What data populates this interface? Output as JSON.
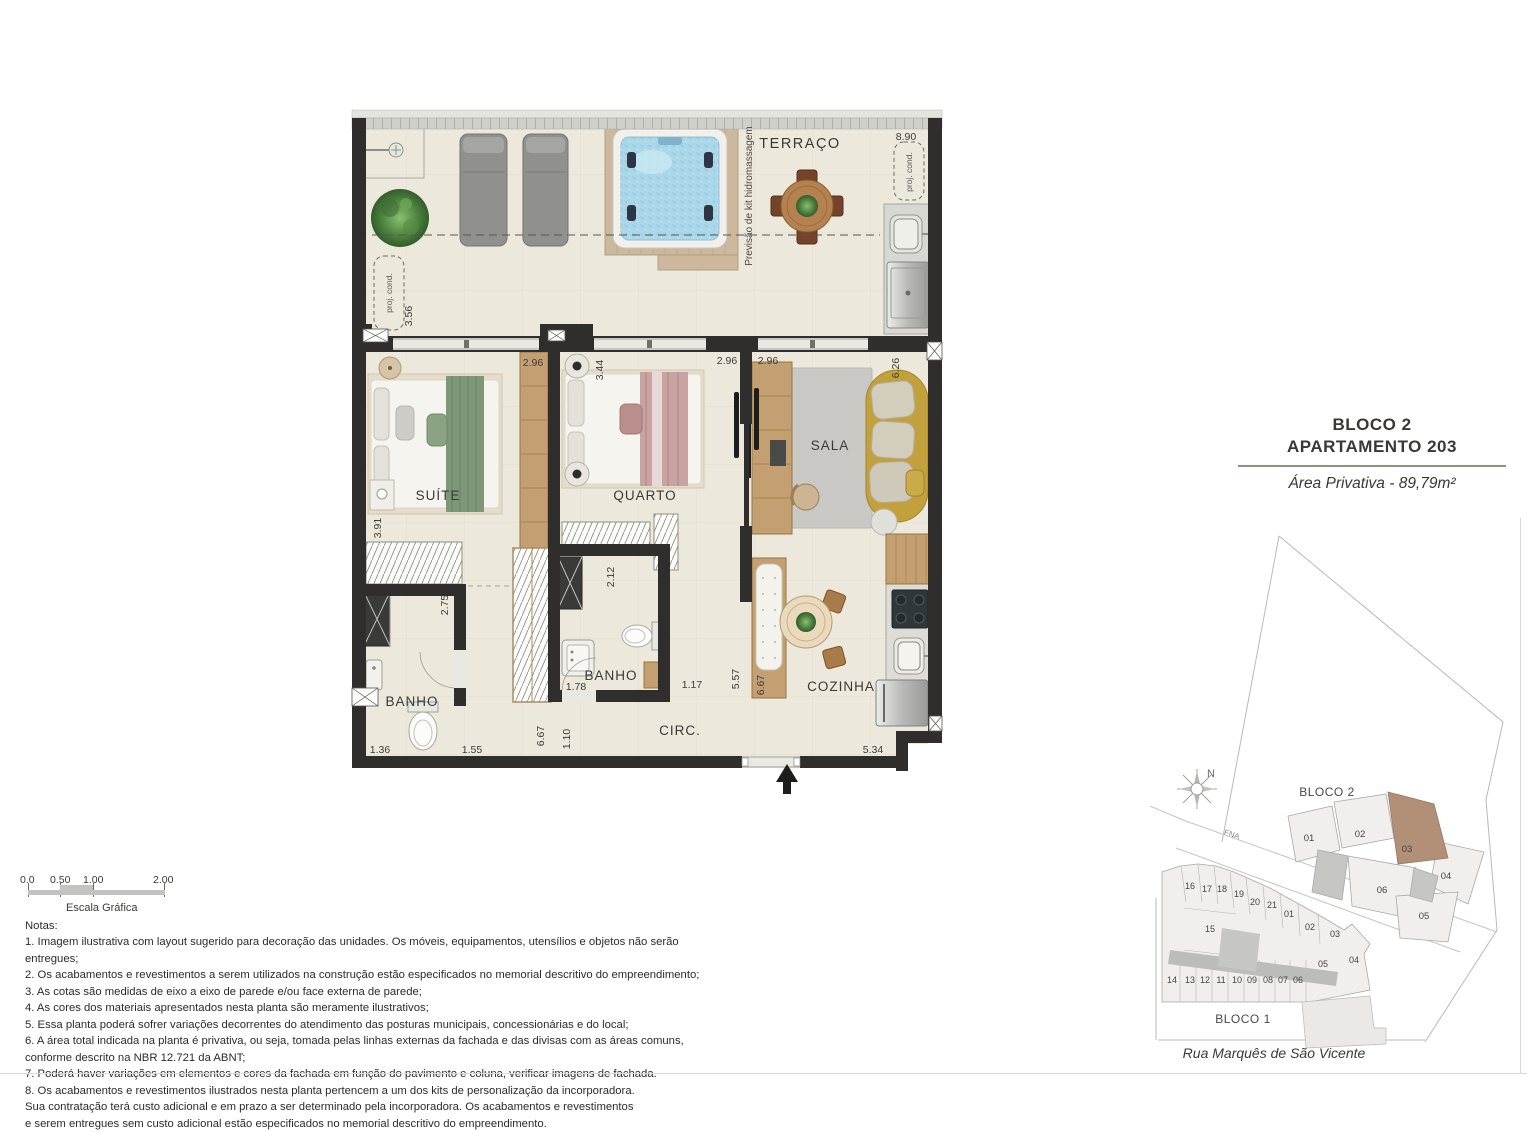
{
  "title_block": {
    "line1": "BLOCO 2",
    "line2": "APARTAMENTO 203",
    "area": "Área Privativa - 89,79m²"
  },
  "floorplan": {
    "labels": {
      "terrace": "TERRAÇO",
      "suite": "SUÍTE",
      "bedroom": "QUARTO",
      "living": "SALA",
      "bath_suite": "BANHO",
      "bath_social": "BANHO",
      "circulation": "CIRC.",
      "kitchen": "COZINHA",
      "hydro_note": "Previsão de kit hidromassagem",
      "proj_cond_left": "proj. cond.",
      "proj_cond_right": "proj. cond."
    },
    "dimensions": {
      "terrace_width": "8.90",
      "terrace_depth": "3.56",
      "suite_window": "2.96",
      "bedroom_depth": "3.44",
      "bedroom_window": "2.96",
      "living_window": "2.96",
      "living_depth": "6.26",
      "suite_depth": "3.91",
      "bath_suite_depth": "2.75",
      "bath_social_depth": "2.12",
      "bath_social_width": "1.78",
      "hall_width": "1.17",
      "hall_depth": "5.57",
      "kitchen_island": "6.67",
      "bath_suite_width": "1.36",
      "closet_width": "1.55",
      "circ_length": "6.67",
      "circ_width": "1.10",
      "kitchen_width": "5.34"
    }
  },
  "scale_bar": {
    "ticks": [
      "0.0",
      "0.50",
      "1.00",
      "2.00"
    ],
    "caption": "Escala Gráfica"
  },
  "notes": {
    "heading": "Notas:",
    "items": [
      "1. Imagem ilustrativa com layout sugerido para decoração das unidades. Os móveis, equipamentos, utensílios e objetos não serão entregues;",
      "2. Os acabamentos e revestimentos a serem utilizados na construção estão especificados no memorial descritivo do empreendimento;",
      "3. As cotas são medidas de eixo a eixo de parede e/ou face externa de parede;",
      "4. As cores dos materiais apresentados nesta planta são meramente ilustrativos;",
      "5. Essa planta poderá sofrer variações decorrentes do atendimento das posturas municipais, concessionárias e do local;",
      "6. A área total indicada na planta é privativa, ou seja, tomada pelas linhas externas da fachada e das divisas com as áreas comuns,\nconforme descrito na NBR 12.721 da ABNT;",
      "7. Poderá haver variações em elementos e cores da fachada em função do pavimento e coluna, verificar imagens de fachada.",
      "8. Os acabamentos e revestimentos ilustrados nesta planta pertencem a um dos kits de personalização da incorporadora.\nSua contratação terá custo adicional e em prazo a ser determinado pela incorporadora. Os acabamentos e revestimentos\ne serem entregues sem custo adicional estão especificados no memorial descritivo do empreendimento."
    ]
  },
  "site_plan": {
    "bloco2_label": "BLOCO 2",
    "bloco1_label": "BLOCO 1",
    "street_name": "Rua Marquês de São Vicente",
    "street_small": "FNA",
    "north": "N",
    "highlighted_unit": "03",
    "bloco2_units": [
      "01",
      "02",
      "03",
      "04",
      "05",
      "06"
    ],
    "bloco1_units_top": [
      "16",
      "17",
      "18",
      "19",
      "20",
      "21",
      "01",
      "02",
      "03"
    ],
    "bloco1_unit_mid": "15",
    "bloco1_units_bottom": [
      "14",
      "13",
      "12",
      "11",
      "10",
      "09",
      "08",
      "07",
      "06",
      "05",
      "04"
    ]
  },
  "colors": {
    "wall": "#2f2e2c",
    "floor": "#ece8dc",
    "wood": "#c49f72",
    "water": "#a9d7e9",
    "sofa": "#c2a13d",
    "highlight_unit": "#b28f77",
    "title_divider": "#9a8b7d"
  }
}
